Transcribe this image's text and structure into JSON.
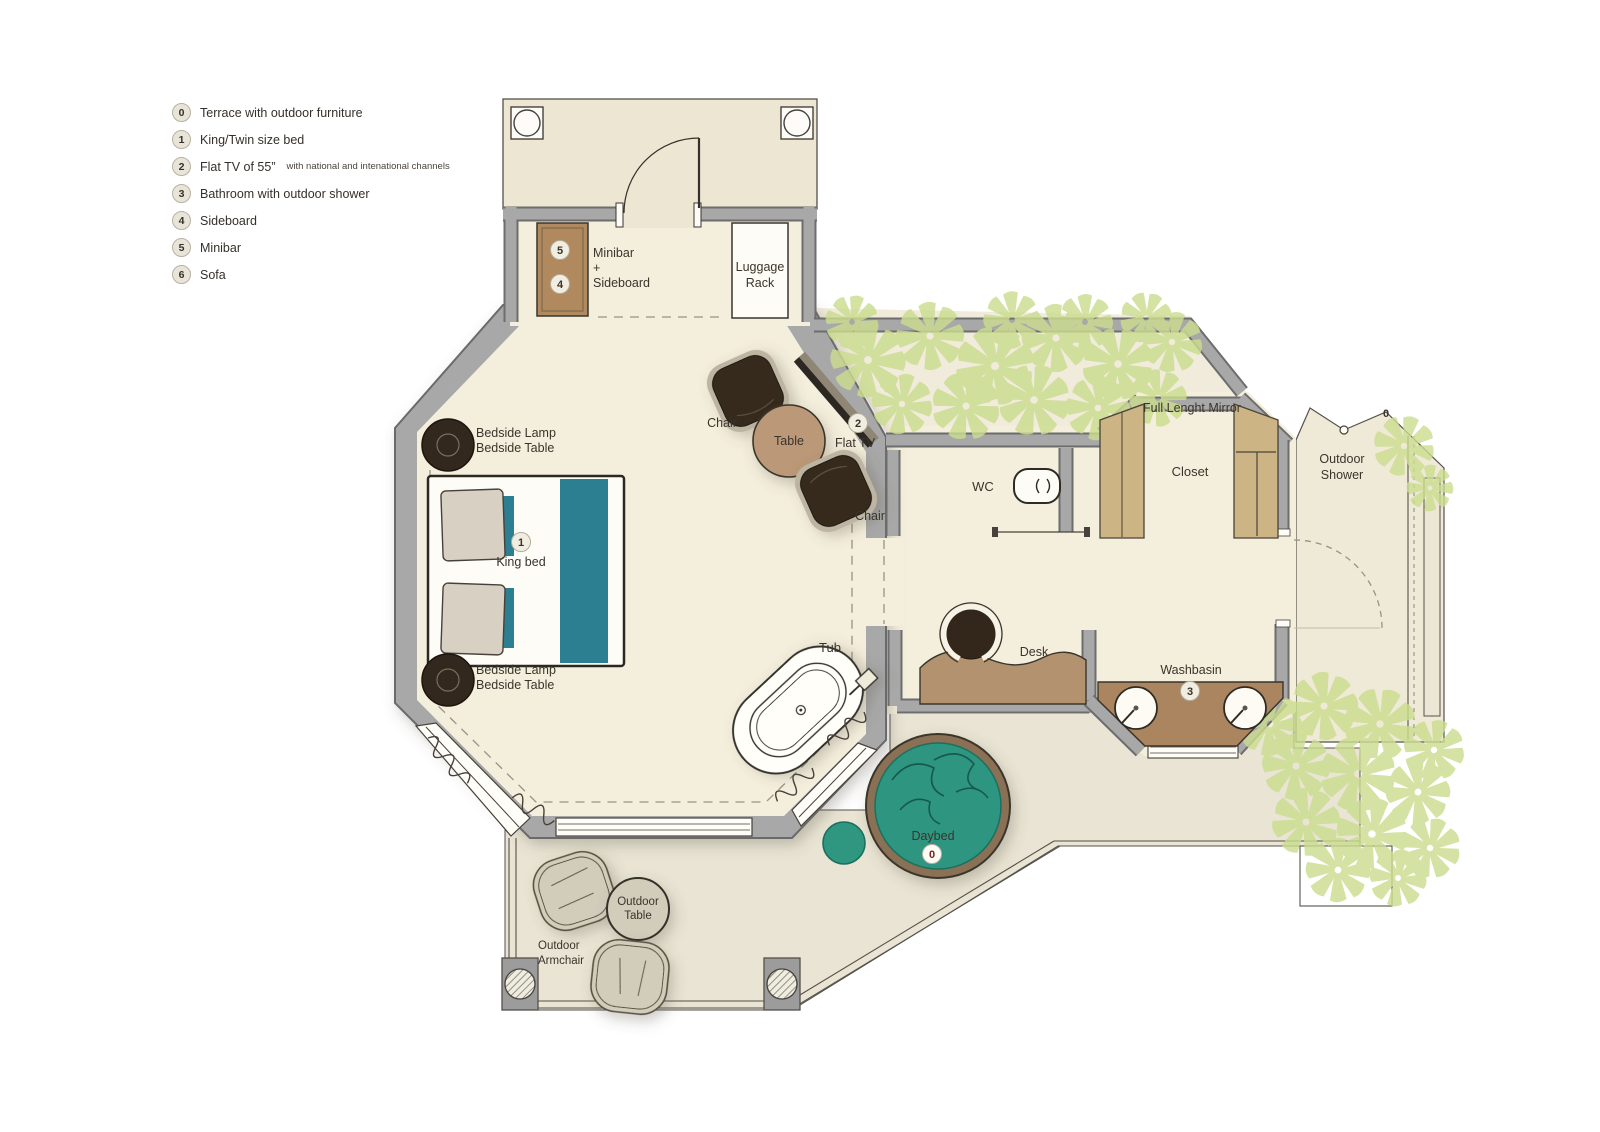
{
  "plan": {
    "legend": {
      "items": [
        {
          "num": "0",
          "label": "Terrace with outdoor furniture"
        },
        {
          "num": "1",
          "label": "King/Twin size bed"
        },
        {
          "num": "2",
          "label": "Flat TV of 55”",
          "note": "with national and intenational channels"
        },
        {
          "num": "3",
          "label": "Bathroom with outdoor shower"
        },
        {
          "num": "4",
          "label": "Sideboard"
        },
        {
          "num": "5",
          "label": "Minibar"
        },
        {
          "num": "6",
          "label": "Sofa"
        }
      ]
    },
    "labels": {
      "minibar_line1": "Minibar",
      "minibar_line2": "+",
      "minibar_line3": "Sideboard",
      "luggage_line1": "Luggage",
      "luggage_line2": "Rack",
      "chair_top": "Chair",
      "table": "Table",
      "chair_bottom": "Chair",
      "flat_tv": "Flat TV",
      "bedside_top_1": "Bedside Lamp",
      "bedside_top_2": "Bedside Table",
      "bedside_bottom_1": "Bedside Lamp",
      "bedside_bottom_2": "Bedside Table",
      "king_bed": "King bed",
      "wc": "WC",
      "full_length_mirror": "Full Lenght Mirror",
      "closet": "Closet",
      "outdoor_shower_1": "Outdoor",
      "outdoor_shower_2": "Shower",
      "desk": "Desk",
      "washbasin": "Washbasin",
      "tub": "Tub",
      "daybed": "Daybed",
      "outdoor_table_1": "Outdoor",
      "outdoor_table_2": "Table",
      "outdoor_armchair_1": "Outdoor",
      "outdoor_armchair_2": "Armchair"
    },
    "markers": {
      "minibar": "5",
      "sideboard": "4",
      "bed": "1",
      "tv": "2",
      "washbasin": "3",
      "daybed": "0",
      "shower": "0"
    },
    "colors": {
      "wall": "#a8a8a8",
      "interior_floor": "#f4eedc",
      "terrace_floor": "#e9e4d3",
      "teal_accent": "#2c7e91",
      "daybed_teal": "#2f9680",
      "wood_brown": "#b08a5e",
      "counter_brown": "#ab8560",
      "foliage_green": "#cbdd8f",
      "chair_dark": "#352a1f"
    }
  }
}
